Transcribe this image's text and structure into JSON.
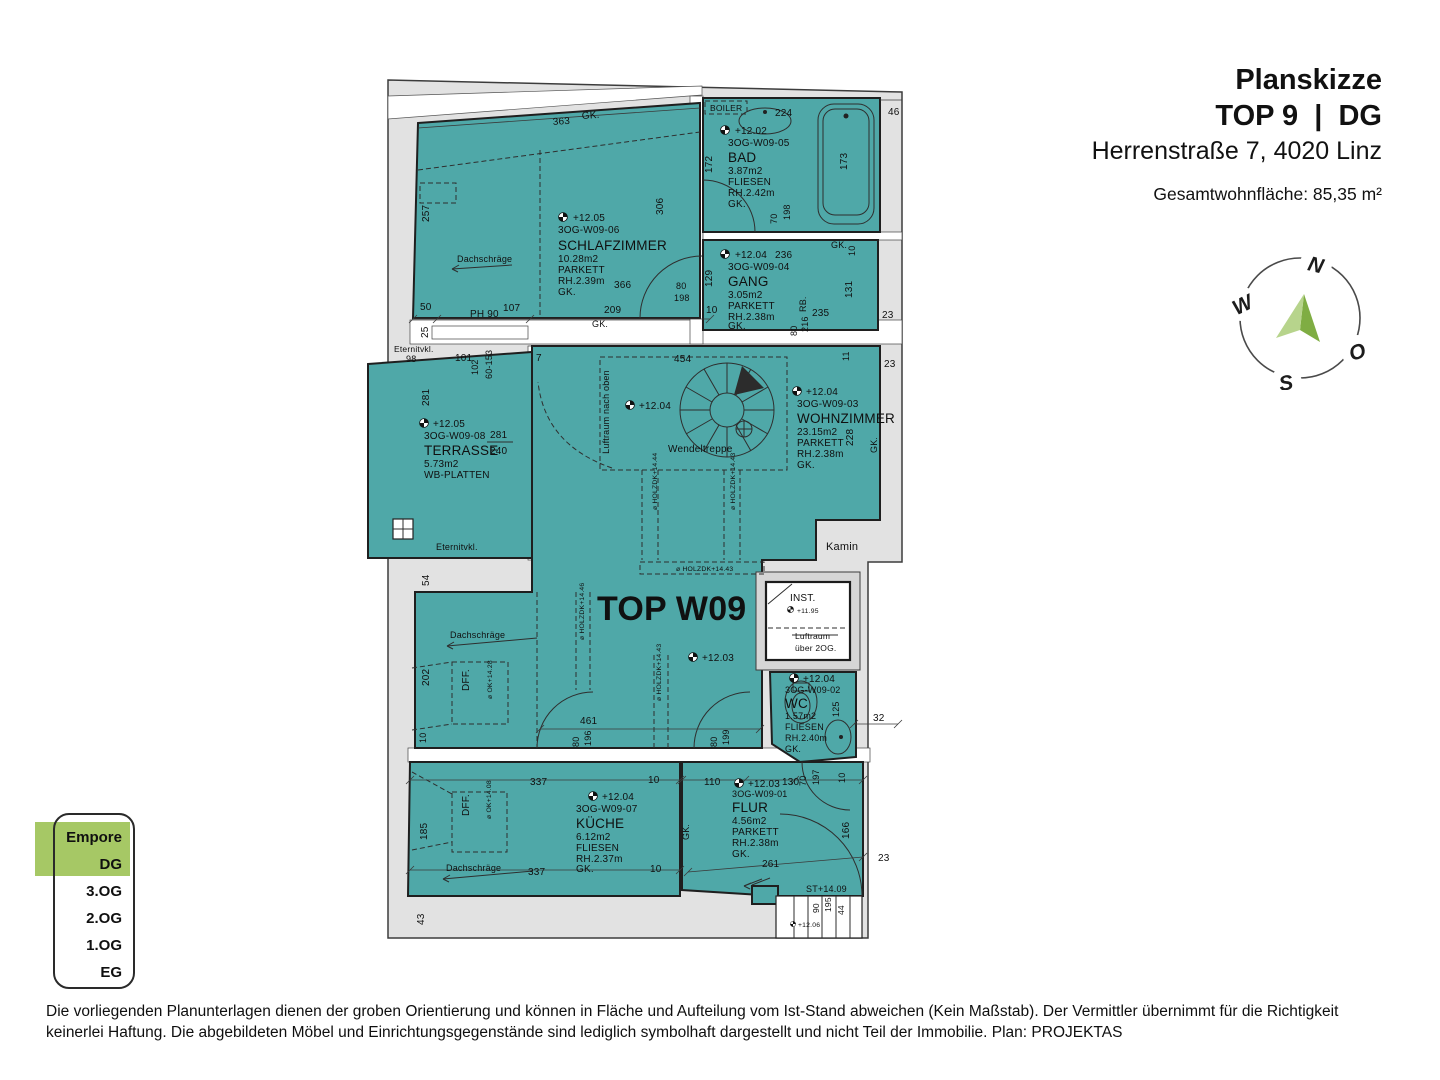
{
  "header": {
    "title": "Planskizze",
    "subtitle": "TOP 9  |  DG",
    "address": "Herrenstraße 7, 4020 Linz",
    "area_total": "Gesamtwohnfläche: 85,35 m²"
  },
  "compass": {
    "n": "N",
    "w": "W",
    "o": "O",
    "s": "S"
  },
  "floor_selector": {
    "highlight_color": "#a6c865",
    "items": [
      {
        "label": "Empore",
        "active": true
      },
      {
        "label": "DG",
        "active": true
      },
      {
        "label": "3.OG",
        "active": false
      },
      {
        "label": "2.OG",
        "active": false
      },
      {
        "label": "1.OG",
        "active": false
      },
      {
        "label": "EG",
        "active": false
      }
    ]
  },
  "disclaimer": "Die vorliegenden Planunterlagen dienen der groben Orientierung und können in Fläche und Aufteilung vom Ist-Stand abweichen (Kein Maßstab). Der Vermittler übernimmt für die Richtigkeit keinerlei Haftung. Die abgebildeten Möbel und Einrichtungsgegenstände sind lediglich symbolhaft dargestellt und nicht Teil der Immobilie. Plan: PROJEKTAS",
  "plan": {
    "unit_label": "TOP W09",
    "colors": {
      "room_fill": "#4FA8A8"
    },
    "rooms": {
      "schlafzimmer": {
        "level": "+12.05",
        "code": "3OG-W09-06",
        "name": "SCHLAFZIMMER",
        "area": "10.28m2",
        "finish": "PARKETT",
        "rh": "RH.2.39m",
        "gk": "GK."
      },
      "bad": {
        "level": "+12.02",
        "code": "3OG-W09-05",
        "name": "BAD",
        "area": "3.87m2",
        "finish": "FLIESEN",
        "rh": "RH.2.42m",
        "gk": "GK."
      },
      "gang": {
        "level": "+12.04",
        "code": "3OG-W09-04",
        "name": "GANG",
        "area": "3.05m2",
        "finish": "PARKETT",
        "rh": "RH.2.38m",
        "gk": "GK."
      },
      "terrasse": {
        "level": "+12.05",
        "code": "3OG-W09-08",
        "name": "TERRASSE",
        "area": "5.73m2",
        "finish": "WB-PLATTEN"
      },
      "wohnzimmer": {
        "level": "+12.04",
        "code": "3OG-W09-03",
        "name": "WOHNZIMMER",
        "area": "23.15m2",
        "finish": "PARKETT",
        "rh": "RH.2.38m",
        "gk": "GK."
      },
      "wc": {
        "level": "+12.04",
        "code": "3OG-W09-02",
        "name": "WC",
        "area": "1.57m2",
        "finish": "FLIESEN",
        "rh": "RH.2.40m",
        "gk": "GK."
      },
      "kueche": {
        "level": "+12.04",
        "code": "3OG-W09-07",
        "name": "KÜCHE",
        "area": "6.12m2",
        "finish": "FLIESEN",
        "rh": "RH.2.37m",
        "gk": "GK."
      },
      "flur": {
        "level": "+12.03",
        "code": "3OG-W09-01",
        "name": "FLUR",
        "area": "4.56m2",
        "finish": "PARKETT",
        "rh": "RH.2.38m",
        "gk": "GK."
      }
    },
    "labels": {
      "dachschraege": "Dachschräge",
      "wendeltreppe": "Wendeltreppe",
      "luftraum_oben": "Luftraum nach oben",
      "kamin": "Kamin",
      "boiler": "BOILER",
      "dff": "DFF.",
      "ok1428": "ø OK+14.28",
      "ok1408": "ø OK+14.08",
      "eternitvkl": "Eternitvkl.",
      "inst": "INST.",
      "inst_lvl": "+11.95",
      "luftraum1": "Luftraum",
      "luftraum2": "über 2OG.",
      "st1409": "ST+14.09",
      "lvl1206": "+12.06",
      "hz1444": "ø HOLZDK+14.44",
      "hz1443": "ø HOLZDK+14.43",
      "hz1446": "ø HOLZDK+14.46",
      "stair_lvl": "+12.04"
    },
    "dims": {
      "t363": "363",
      "tgk": "GK.",
      "l257": "257",
      "r306": "306",
      "s366": "366",
      "s80": "80",
      "s198": "198",
      "c209": "209",
      "cgk": "GK.",
      "c107": "107",
      "cph90": "PH 90",
      "c50": "50",
      "c25": "25",
      "c10": "10",
      "b224": "224",
      "b172": "172",
      "b173": "173",
      "b46": "46",
      "b70": "70",
      "b198": "198",
      "g236": "236",
      "g129": "129",
      "g131": "131",
      "grb": "RB.",
      "g235": "235",
      "g80": "80",
      "g216": "216",
      "ggk": "GK.",
      "ggk10": "10",
      "g23": "23",
      "te98": "98",
      "te101": "101",
      "te102": "102",
      "te60": "60-153",
      "te7": "7",
      "te281v": "281",
      "te281": "281",
      "te240": "240",
      "st454": "454",
      "st11": "11",
      "w23": "23",
      "w228": "228",
      "wgk": "GK.",
      "t54": "54",
      "t202": "202",
      "t10": "10",
      "t461": "461",
      "t80a": "80",
      "t196": "196",
      "t80b": "80",
      "t199": "199",
      "wc125": "125",
      "wc32": "32",
      "k337t": "337",
      "k10t": "10",
      "k337b": "337",
      "k10b": "10",
      "k185": "185",
      "k43": "43",
      "f110": "110",
      "f130": "130",
      "f70": "70",
      "f197": "197",
      "f10": "10",
      "f166": "166",
      "f261": "261",
      "f23": "23",
      "fgk": "GK.",
      "s90": "90",
      "s195": "195",
      "s44": "44"
    }
  }
}
